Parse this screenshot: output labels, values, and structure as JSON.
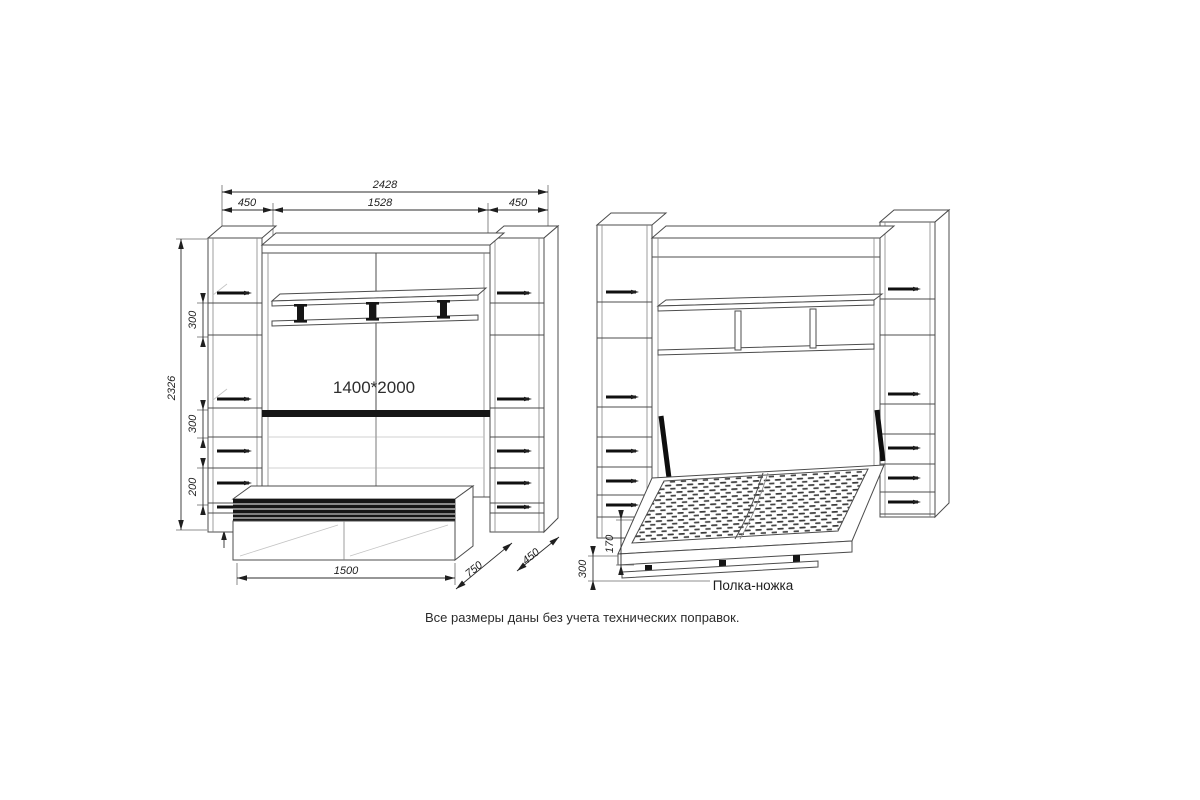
{
  "note": {
    "text": "Все размеры даны без учета технических поправок."
  },
  "closed_view": {
    "dims": {
      "total_width": "2428",
      "left_section_width": "450",
      "middle_section_width": "1528",
      "right_section_width": "450",
      "total_height": "2326",
      "upper_shelf_gap": "300",
      "lower_shelf_gap": "300",
      "drawer_section_height": "200",
      "base_height": "80",
      "bed_box_width": "1500",
      "bed_box_depth": "750",
      "cabinet_depth": "450",
      "bed_size": "1400*2000"
    }
  },
  "open_view": {
    "dims": {
      "frame_height": "170",
      "leg_shelf_height": "300"
    },
    "labels": {
      "leg_shelf": "Полка-ножка"
    }
  }
}
